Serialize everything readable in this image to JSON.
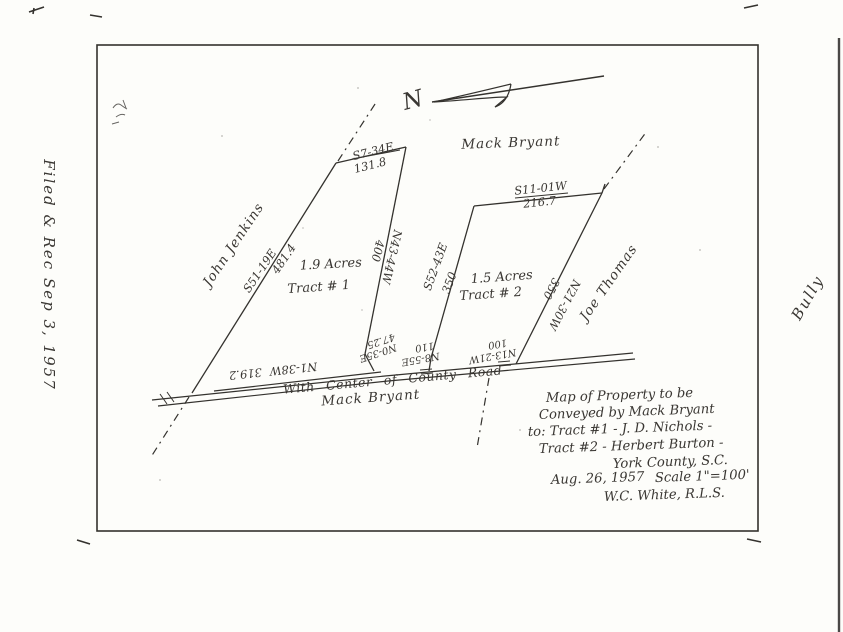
{
  "document": {
    "ink_color": "#34322e",
    "paper_color": "#fdfdfa"
  },
  "margins": {
    "left_note": "Filed & Rec  Sep 3, 1957",
    "right_note": "Bully"
  },
  "map": {
    "north_letter": "N",
    "owner_top": "Mack Bryant",
    "owner_left": "John Jenkins",
    "owner_right": "Joe Thomas",
    "road": {
      "label": "With Center of County Road",
      "owner": "Mack Bryant",
      "bearing": "N1-38W",
      "distance": "319.2",
      "seg1_bearing": "N0-35E",
      "seg1_distance": "47.25",
      "seg2_bearing": "N8-55E",
      "seg2_distance": "110",
      "seg3_bearing": "N13-21W",
      "seg3_distance": "100"
    },
    "tract1": {
      "acreage": "1.9 Acres",
      "label": "Tract # 1",
      "top_bearing": "S7-34E",
      "top_distance": "131.8",
      "left_bearing": "S51-19E",
      "left_distance": "481.4",
      "right_bearing": "N43-44W",
      "right_distance": "400"
    },
    "tract2": {
      "acreage": "1.5 Acres",
      "label": "Tract # 2",
      "top_bearing": "S11-01W",
      "top_distance": "216.7",
      "left_bearing": "S52-43E",
      "left_distance": "350",
      "right_bearing": "N21-30W",
      "right_distance": "350"
    },
    "legend": {
      "line1": "Map of Property to be",
      "line2": "Conveyed by Mack Bryant",
      "line3": "to: Tract #1 -  J. D. Nichols -",
      "line4": "Tract #2 -  Herbert Burton -",
      "line5": "York County, S.C.",
      "date": "Aug. 26, 1957",
      "scale": "Scale 1\"=100'",
      "surveyor": "W.C. White, R.L.S."
    }
  }
}
